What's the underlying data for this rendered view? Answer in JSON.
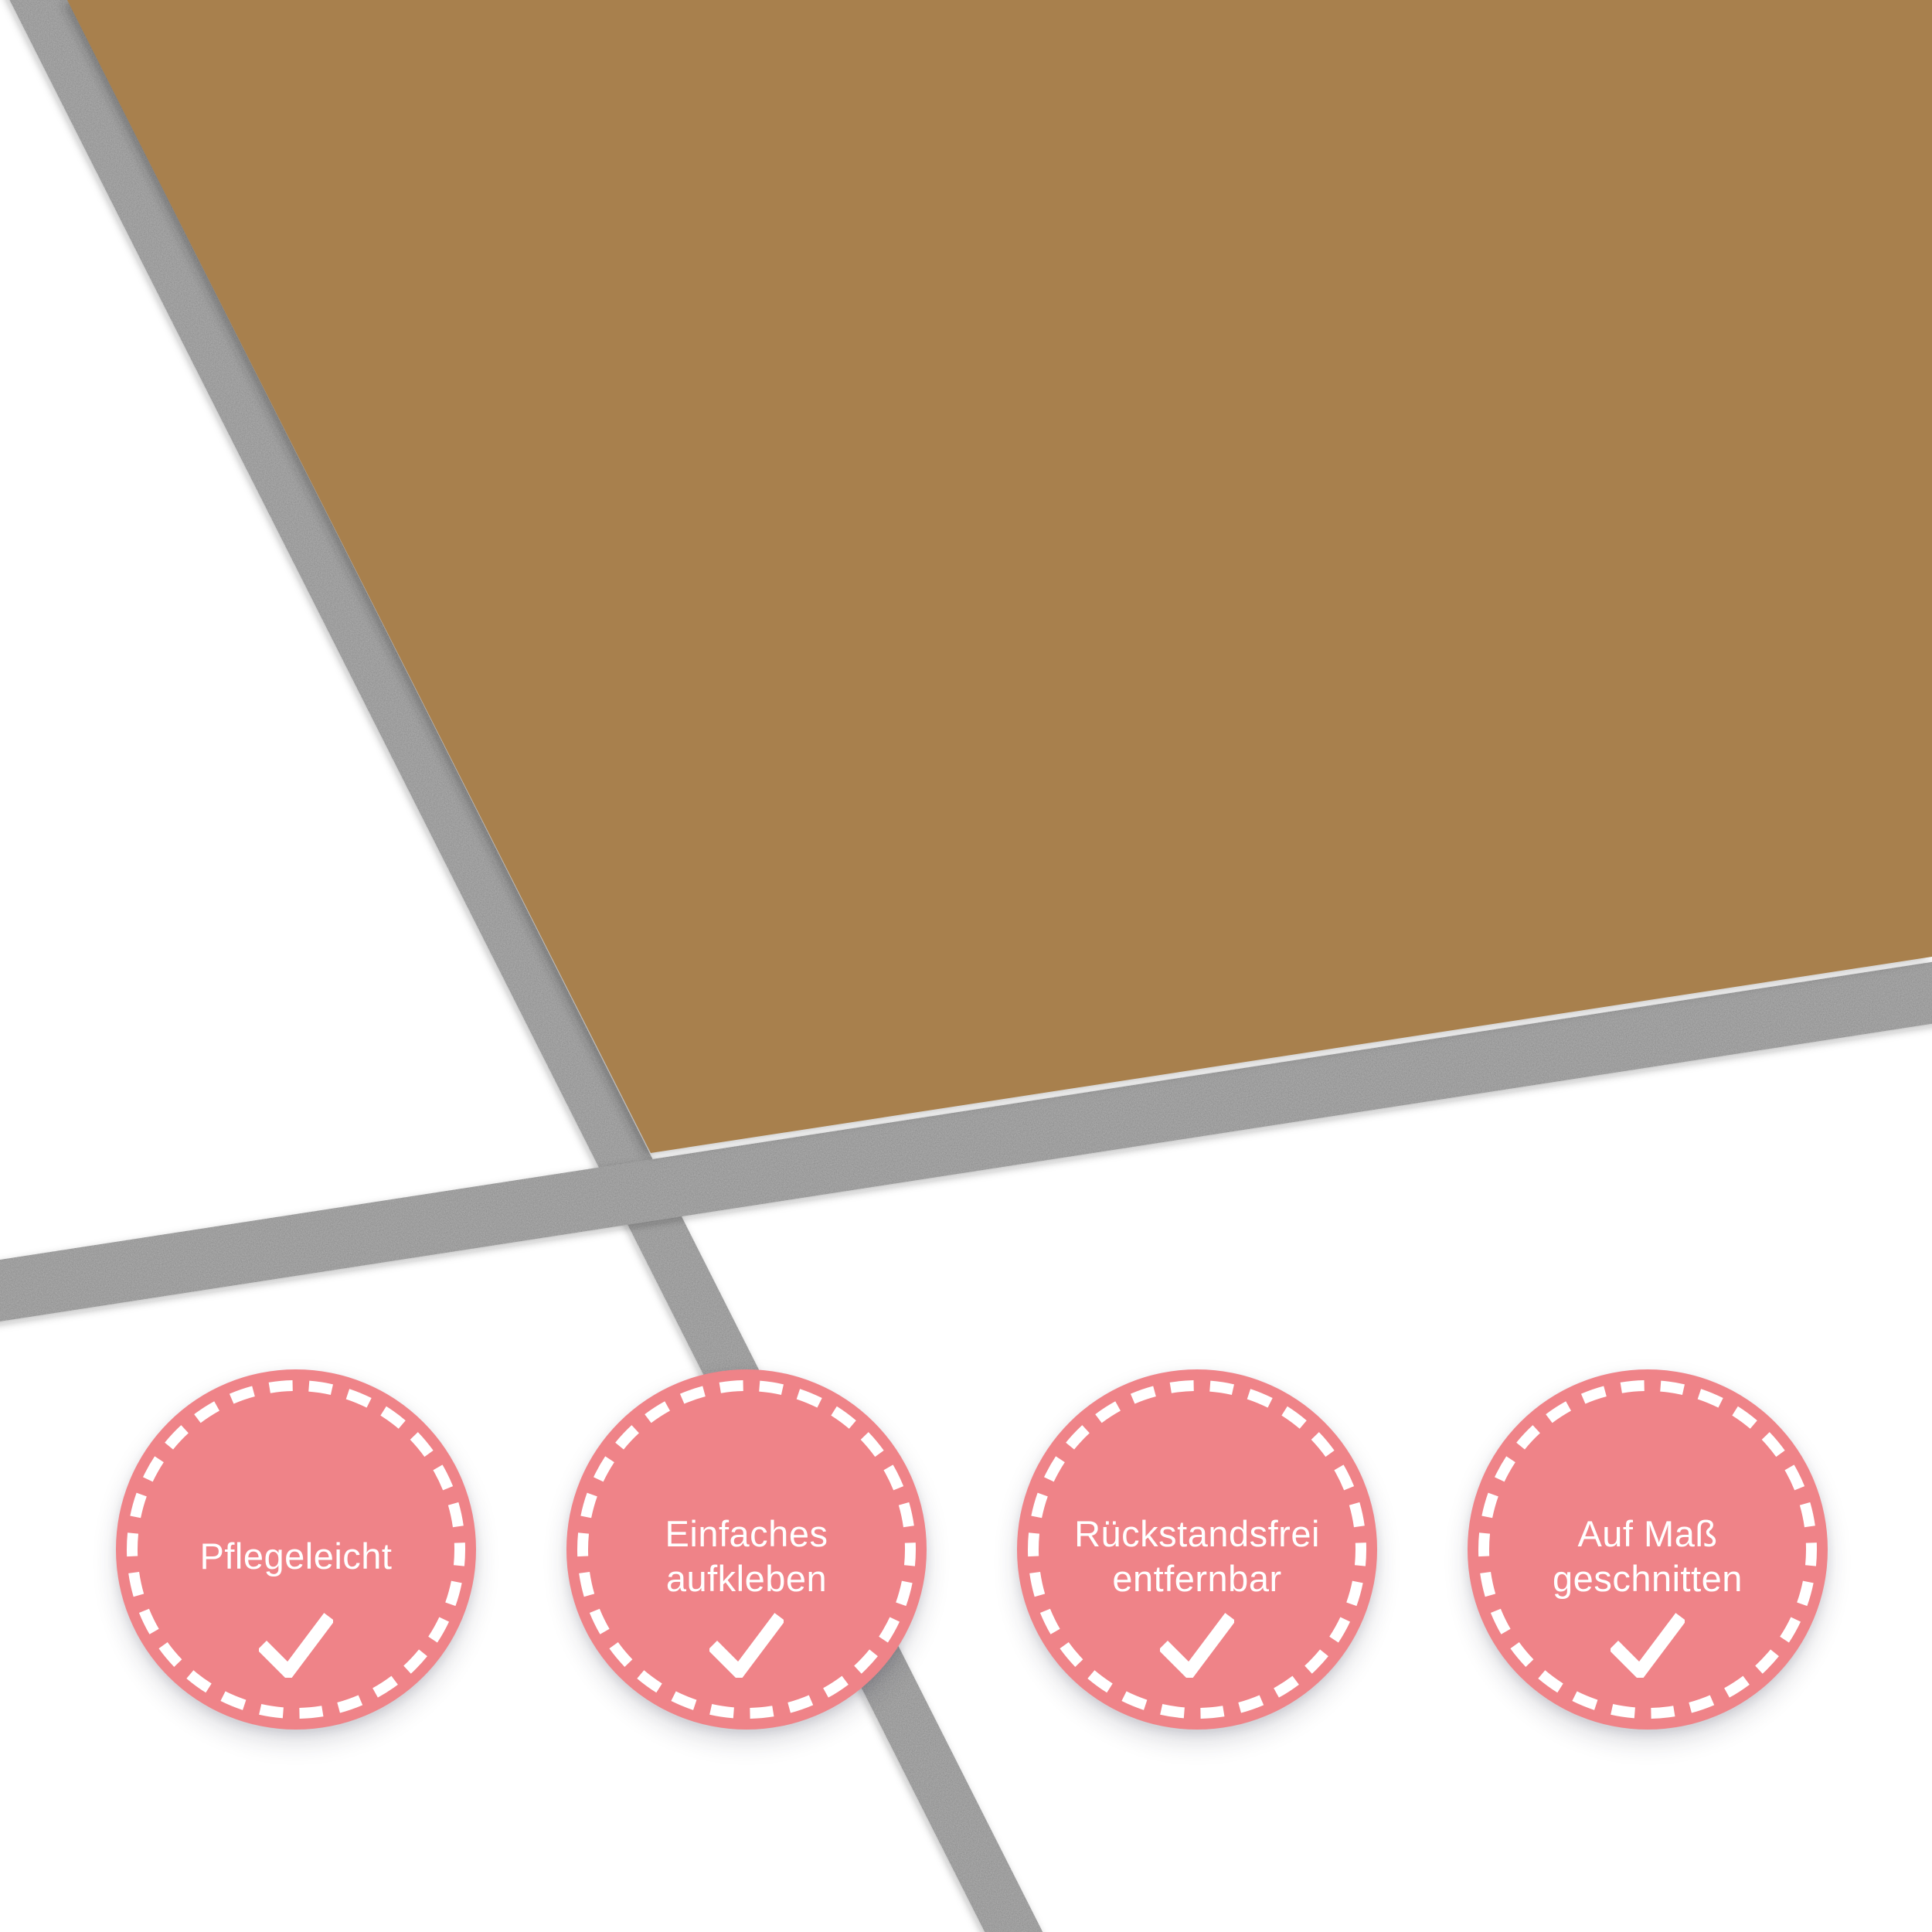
{
  "colors": {
    "film": "#a8804e",
    "tile": "#ffffff",
    "grout": "#8e8e8e",
    "badge": "#ef8388",
    "badge_text": "#ffffff"
  },
  "badges": [
    {
      "line1": "Pflegeleicht",
      "line2": "",
      "icon": "checkmark"
    },
    {
      "line1": "Einfaches",
      "line2": "aufkleben",
      "icon": "checkmark"
    },
    {
      "line1": "Rückstandsfrei",
      "line2": "entfernbar",
      "icon": "checkmark"
    },
    {
      "line1": "Auf Maß",
      "line2": "geschnitten",
      "icon": "checkmark"
    }
  ]
}
